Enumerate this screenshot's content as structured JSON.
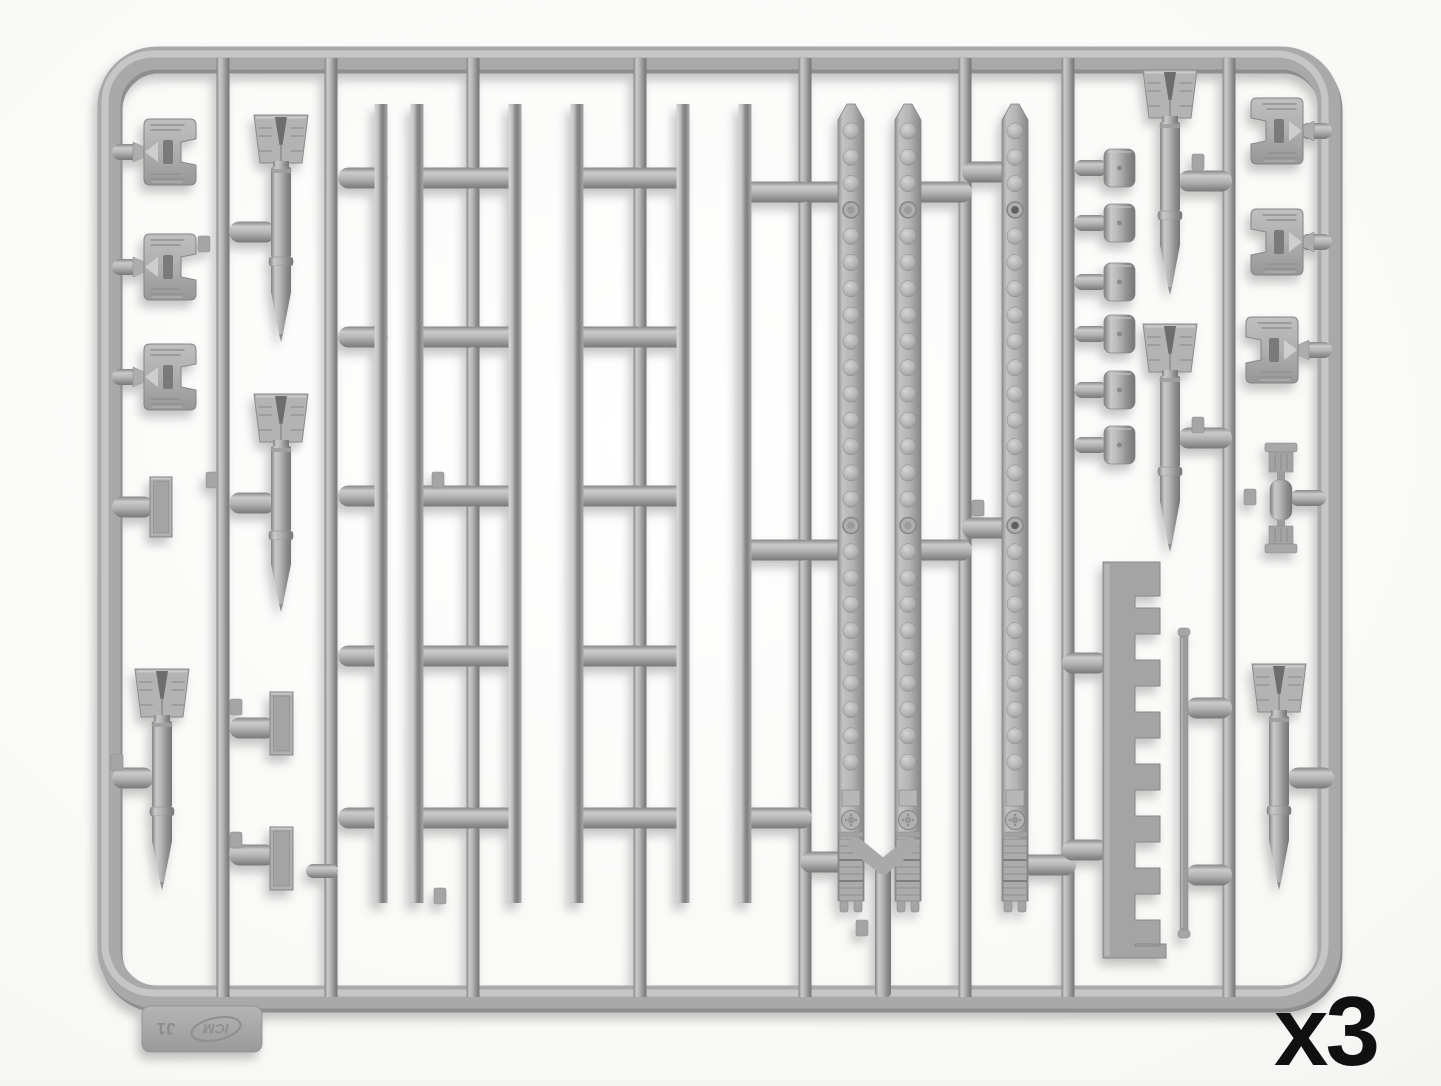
{
  "photo": {
    "subject": "Light grey injection-molded plastic model sprue with aircraft ordnance parts: six finned bombs, six long launch-rail rods, three perforated rack beams, fin clips, cap fittings, a toothed rack bar and a thin rod",
    "quantity_label": "x3",
    "sprue_tag": {
      "brand": "ICM",
      "code": "J1"
    },
    "colors": {
      "background_center": "#ffffff",
      "background_edge": "#e9e9e7",
      "plastic": "#a8a8a8",
      "plastic_light": "#cdcdcd",
      "plastic_dark": "#7c7c7c",
      "label_text": "#101010"
    }
  },
  "sprue": {
    "frame": {
      "x": 109,
      "y": 58,
      "w": 1220,
      "h": 939,
      "r": 48,
      "t": 23
    },
    "runner_w": 13,
    "runners_x": [
      223,
      331,
      473,
      640,
      805,
      965,
      1068,
      1229
    ],
    "trunk": {
      "x": 883,
      "y1": 862,
      "y2": 997
    },
    "rails": {
      "xs": [
        381,
        417,
        515,
        577,
        683,
        745
      ],
      "y1": 104,
      "y2": 903,
      "w": 13
    },
    "capsule_groups": [
      {
        "x1": 338,
        "x2": 388,
        "ys": [
          178,
          337,
          496,
          656,
          818
        ]
      },
      {
        "x1": 411,
        "x2": 480,
        "ys": [
          178,
          337,
          496,
          656,
          818
        ]
      },
      {
        "x1": 466,
        "x2": 521,
        "ys": [
          178,
          337,
          496,
          656,
          818
        ]
      },
      {
        "x1": 571,
        "x2": 647,
        "ys": [
          178,
          337,
          496,
          656,
          818
        ]
      },
      {
        "x1": 633,
        "x2": 689,
        "ys": [
          178,
          337,
          496,
          656,
          818
        ]
      },
      {
        "x1": 739,
        "x2": 812,
        "ys": [
          192,
          550,
          818
        ]
      },
      {
        "x1": 800,
        "x2": 858,
        "ys": [
          192,
          550,
          862
        ]
      },
      {
        "x1": 902,
        "x2": 972,
        "ys": [
          192,
          550
        ]
      },
      {
        "x1": 962,
        "x2": 1022,
        "ys": [
          172,
          528
        ]
      },
      {
        "x1": 1010,
        "x2": 1076,
        "ys": [
          865
        ]
      },
      {
        "x1": 1062,
        "x2": 1108,
        "ys": [
          663,
          850
        ]
      },
      {
        "x1": 1186,
        "x2": 1232,
        "ys": [
          708,
          875
        ]
      },
      {
        "x1": 229,
        "x2": 276,
        "ys": [
          232,
          503,
          728,
          855
        ]
      },
      {
        "x1": 112,
        "x2": 154,
        "ys": [
          507,
          778
        ]
      },
      {
        "x1": 1178,
        "x2": 1232,
        "ys": [
          181,
          438
        ]
      },
      {
        "x1": 1288,
        "x2": 1334,
        "ys": [
          778
        ]
      },
      {
        "x1": 112,
        "x2": 142,
        "ys": [
          152,
          267,
          377
        ],
        "h": 16
      },
      {
        "x1": 1300,
        "x2": 1332,
        "ys": [
          131,
          242,
          350
        ],
        "h": 16
      },
      {
        "x1": 1290,
        "x2": 1326,
        "ys": [
          498
        ],
        "h": 16
      },
      {
        "x1": 306,
        "x2": 338,
        "ys": [
          871
        ],
        "h": 14
      }
    ],
    "strips": {
      "xs": [
        851,
        908,
        1015
      ],
      "dark_rings": [
        false,
        false,
        true
      ],
      "w": 26,
      "y_top": 104,
      "y_shoulder": 120,
      "y_body_bottom": 901,
      "dimple_start": 131,
      "dimple_step": 26.3,
      "dimple_count": 25,
      "ring_indices": [
        3,
        15
      ],
      "detail_top": 790
    },
    "y_connector": {
      "arms": [
        [
          856,
          845
        ],
        [
          910,
          845
        ]
      ],
      "mx": 883,
      "my": 867
    },
    "bombs": [
      {
        "cx": 281,
        "top": 113,
        "tip": 342
      },
      {
        "cx": 281,
        "top": 392,
        "tip": 612
      },
      {
        "cx": 162,
        "top": 667,
        "tip": 890
      },
      {
        "cx": 1170,
        "top": 68,
        "tip": 295
      },
      {
        "cx": 1170,
        "top": 322,
        "tip": 552
      },
      {
        "cx": 1279,
        "top": 662,
        "tip": 890
      }
    ],
    "clips": [
      {
        "cx": 170,
        "cy": 152,
        "mirror": false
      },
      {
        "cx": 170,
        "cy": 267,
        "mirror": false
      },
      {
        "cx": 170,
        "cy": 377,
        "mirror": false
      },
      {
        "cx": 1277,
        "cy": 131,
        "mirror": true
      },
      {
        "cx": 1277,
        "cy": 242,
        "mirror": true
      },
      {
        "cx": 1272,
        "cy": 350,
        "mirror": true
      }
    ],
    "caps": {
      "ys": [
        168,
        223,
        282,
        334,
        390,
        445
      ],
      "stub_x": 1074,
      "head_x": 1104,
      "head_w": 31,
      "head_h": 38
    },
    "rects": [
      {
        "x": 150,
        "y": 477,
        "w": 22,
        "h": 60
      },
      {
        "x": 270,
        "y": 692,
        "w": 23,
        "h": 63
      },
      {
        "x": 270,
        "y": 827,
        "w": 23,
        "h": 63
      }
    ],
    "rack": {
      "x": 1103,
      "bar_w": 32,
      "tooth_w": 25,
      "y_top": 562,
      "head_h": 34,
      "teeth_start": 608,
      "teeth_pitch": 52,
      "tooth_h": 26,
      "teeth_count": 7,
      "base_y": 944,
      "y_bottom": 958,
      "base_ext": 6
    },
    "rod": {
      "x": 1180,
      "y1": 634,
      "y2": 932,
      "w": 8
    },
    "cross_part": {
      "cx": 1281,
      "cy": 498
    },
    "nubs": [
      [
        212,
        480
      ],
      [
        117,
        762
      ],
      [
        236,
        707
      ],
      [
        236,
        840
      ],
      [
        438,
        480
      ],
      [
        440,
        896
      ],
      [
        862,
        928
      ],
      [
        978,
        508
      ],
      [
        1250,
        497
      ],
      [
        1198,
        162
      ],
      [
        1198,
        425
      ],
      [
        204,
        244
      ]
    ],
    "tag": {
      "x": 142,
      "y": 1006,
      "w": 120,
      "h": 46
    }
  }
}
